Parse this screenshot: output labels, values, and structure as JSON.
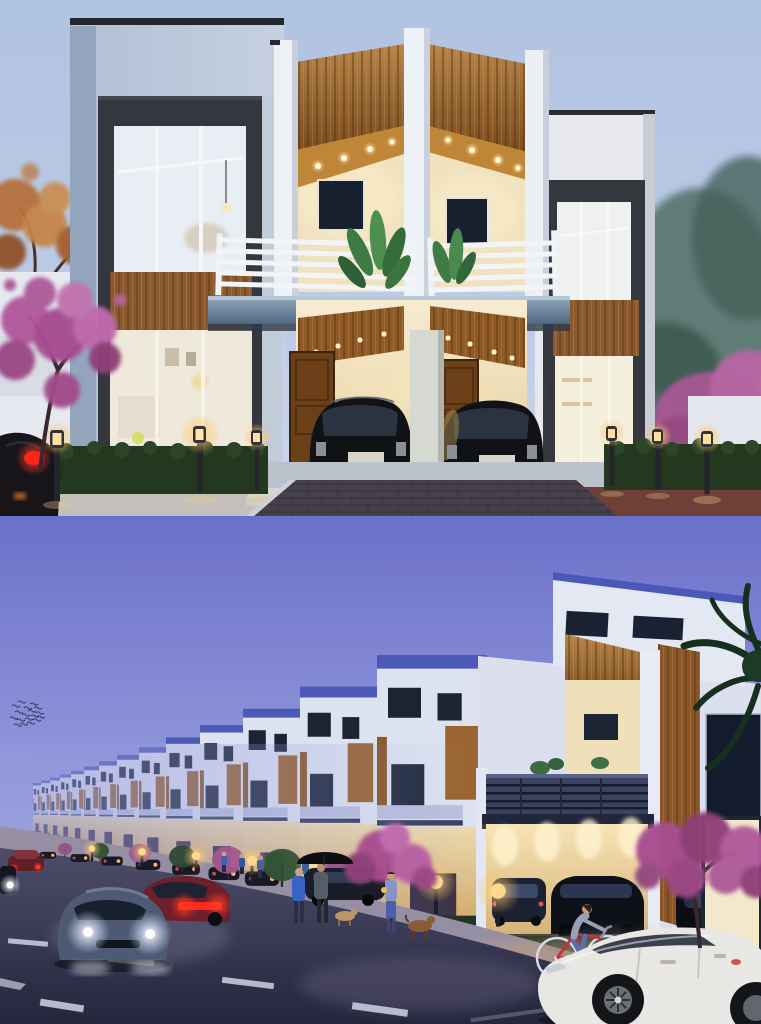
{
  "meta": {
    "title": "Row-house project — dusk architectural renders",
    "type": "3d-render-collage",
    "panels": 2
  },
  "palette": {
    "sky_top_panel": "#b3c6e3",
    "sky_bottom_panel": "#6d72ca",
    "wood_accent": "#a06a32",
    "cream_lit_wall": "#f3e6c4",
    "charcoal_frame": "#34373e",
    "balcony_steel": "#5d7795",
    "roof_coping_blue": "#4c59b9",
    "hedge_green": "#24381f",
    "street_asphalt": "#31334c",
    "bougainvillea_pink": "#a74e90",
    "warm_light": "#ffd98f",
    "headlight_white": "#ffffff",
    "taillight_red": "#ff3a22",
    "white_car_body": "#e9e7e3",
    "black_car_body": "#101216"
  },
  "top_panel": {
    "label": "Front elevation of a modern twin duplex at dusk with two black hatchbacks parked in lit carports",
    "objects": [
      "dusk sky",
      "autumn tree",
      "bougainvillea trees",
      "left tower window",
      "wood slat canopy",
      "balcony railing",
      "balcony plants",
      "wooden entry doors",
      "black hatchback cars",
      "garden bollard lights",
      "hedges",
      "paver driveway"
    ]
  },
  "bottom_panel": {
    "label": "Street perspective of a long row of townhouses at dusk with traffic, pedestrians and a cyclist",
    "objects": [
      "purple dusk sky",
      "bird flock",
      "receding row houses",
      "palm fronds",
      "sedan with headlights",
      "red sedan taillights",
      "white sedan",
      "red bicycle",
      "pedestrians with umbrella",
      "dogs",
      "bougainvillea trees",
      "bollard lights"
    ],
    "far_houses": [
      {
        "x": 41,
        "w": 8
      },
      {
        "x": 50,
        "w": 9
      },
      {
        "x": 60,
        "w": 10
      },
      {
        "x": 71,
        "w": 11
      },
      {
        "x": 84,
        "w": 13
      },
      {
        "x": 99,
        "w": 15
      },
      {
        "x": 117,
        "w": 18
      },
      {
        "x": 139,
        "w": 22
      },
      {
        "x": 166,
        "w": 27
      },
      {
        "x": 200,
        "w": 34
      },
      {
        "x": 243,
        "w": 43
      },
      {
        "x": 300,
        "w": 57
      },
      {
        "x": 377,
        "w": 77
      },
      {
        "x": 487,
        "w": 110
      }
    ],
    "bollards": [
      92,
      142,
      196,
      252,
      312,
      372,
      436,
      498
    ],
    "parked_cars": [
      48,
      80,
      112,
      148,
      186,
      224,
      262
    ],
    "bushes": [
      {
        "x": 65,
        "r": 7,
        "c": "#8f5384"
      },
      {
        "x": 100,
        "r": 9,
        "c": "#30502f"
      },
      {
        "x": 140,
        "r": 11,
        "c": "#9a5a8e"
      },
      {
        "x": 182,
        "r": 13,
        "c": "#2e4a34"
      },
      {
        "x": 228,
        "r": 16,
        "c": "#a05890"
      },
      {
        "x": 282,
        "r": 19,
        "c": "#315236"
      },
      {
        "x": 336,
        "r": 21,
        "c": "#9c5a92"
      }
    ],
    "birds": [
      [
        12,
        190
      ],
      [
        18,
        186
      ],
      [
        24,
        192
      ],
      [
        30,
        188
      ],
      [
        15,
        196
      ],
      [
        22,
        199
      ],
      [
        28,
        195
      ],
      [
        34,
        192
      ],
      [
        10,
        202
      ],
      [
        17,
        204
      ],
      [
        25,
        203
      ],
      [
        31,
        200
      ],
      [
        36,
        197
      ],
      [
        20,
        208
      ],
      [
        27,
        207
      ],
      [
        33,
        204
      ],
      [
        14,
        209
      ],
      [
        37,
        201
      ]
    ]
  }
}
